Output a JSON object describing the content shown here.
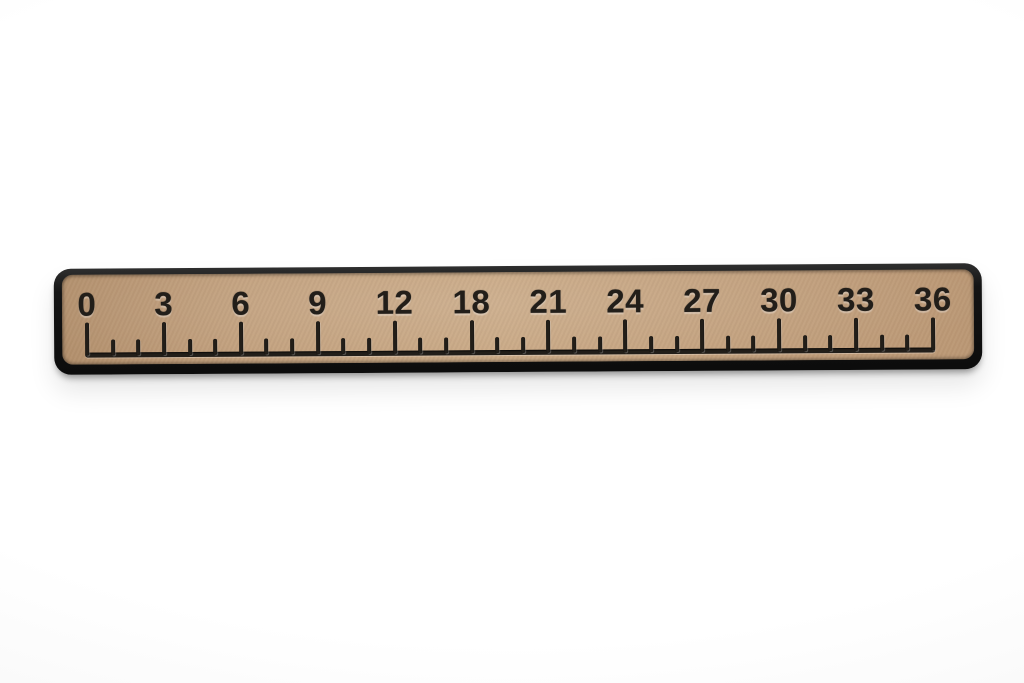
{
  "photo": {
    "subject": "Tan foam ruler with black engraved numbers and tick marks on a white background",
    "background_color": "#f7f7f7"
  },
  "ruler": {
    "unit_labels": [
      "0",
      "3",
      "6",
      "9",
      "12",
      "18",
      "21",
      "24",
      "27",
      "30",
      "33",
      "36"
    ],
    "minor_ticks_between_labels": 2,
    "colors": {
      "surface": "#c2a07d",
      "rim": "#141414",
      "markings": "#221e19"
    }
  }
}
